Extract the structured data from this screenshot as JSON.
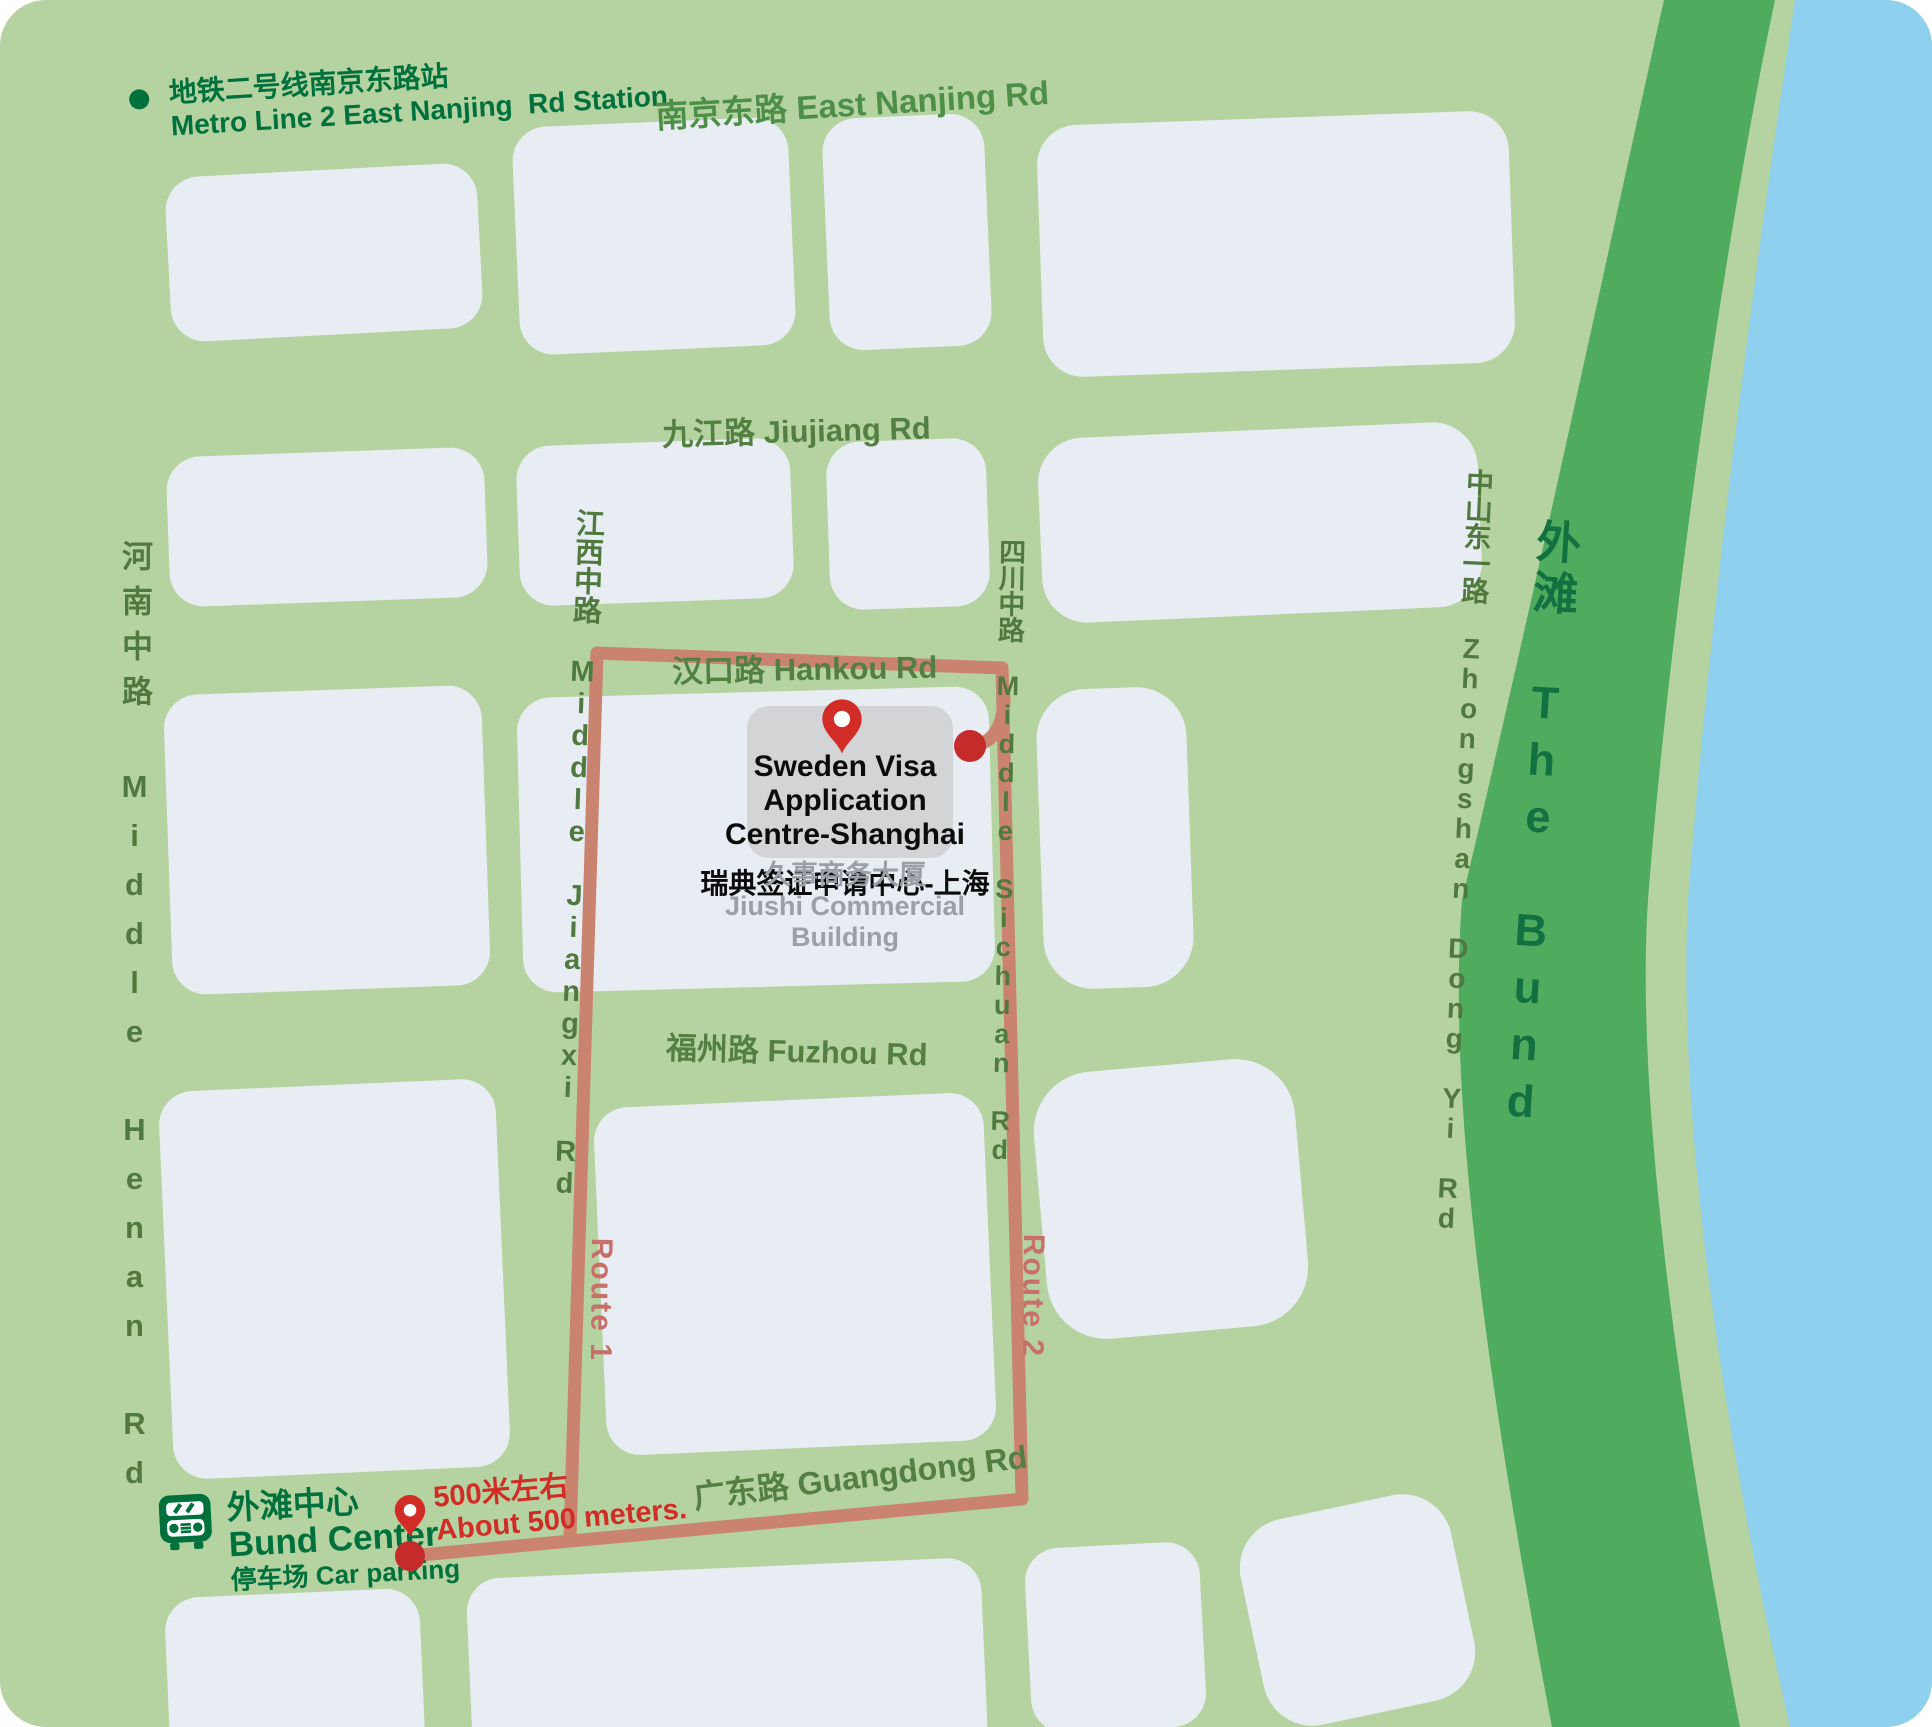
{
  "map": {
    "colors": {
      "map_bg": "#b5d3a0",
      "block": "#e8edf4",
      "building": "#d3d4d6",
      "bund_strip": "#4fab5e",
      "water": "#8fd0ee",
      "route": "#c9836f",
      "route_label": "#c7706a",
      "road_label": "#537f42",
      "dark_green_text": "#00713c",
      "bund_text": "#137041",
      "red": "#d22c26"
    },
    "metro_station": {
      "zh": "地铁二号线南京东路站",
      "en": "Metro Line 2 East Nanjing  Rd Station"
    },
    "roads": {
      "east_nanjing": "南京东路 East Nanjing Rd",
      "jiujiang": "九江路 Jiujiang Rd",
      "hankou": "汉口路 Hankou Rd",
      "fuzhou": "福州路 Fuzhou Rd",
      "guangdong": "广东路 Guangdong Rd",
      "henan": "河南中路 Middle Henan Rd",
      "jiangxi": "江西中路 Middle Jiangxi Rd",
      "sichuan": "四川中路 Middle Sichuan Rd",
      "zhongshan": "中山东一路 Zhongshan Dong Yi Rd",
      "bund": "外滩 The Bund"
    },
    "destination": {
      "name_line1": "Sweden Visa Application",
      "name_line2": "Centre-Shanghai",
      "name_zh": "瑞典签证申请中心-上海",
      "building_zh": "久事商务大厦",
      "building_en": "Jiushi Commercial Building"
    },
    "bund_center": {
      "zh": "外滩中心",
      "en": "Bund Center",
      "parking": "停车场 Car parking"
    },
    "distance": {
      "zh": "500米左右",
      "en": "About 500 meters."
    },
    "routes": {
      "route1": "Route 1",
      "route2": "Route 2"
    }
  }
}
